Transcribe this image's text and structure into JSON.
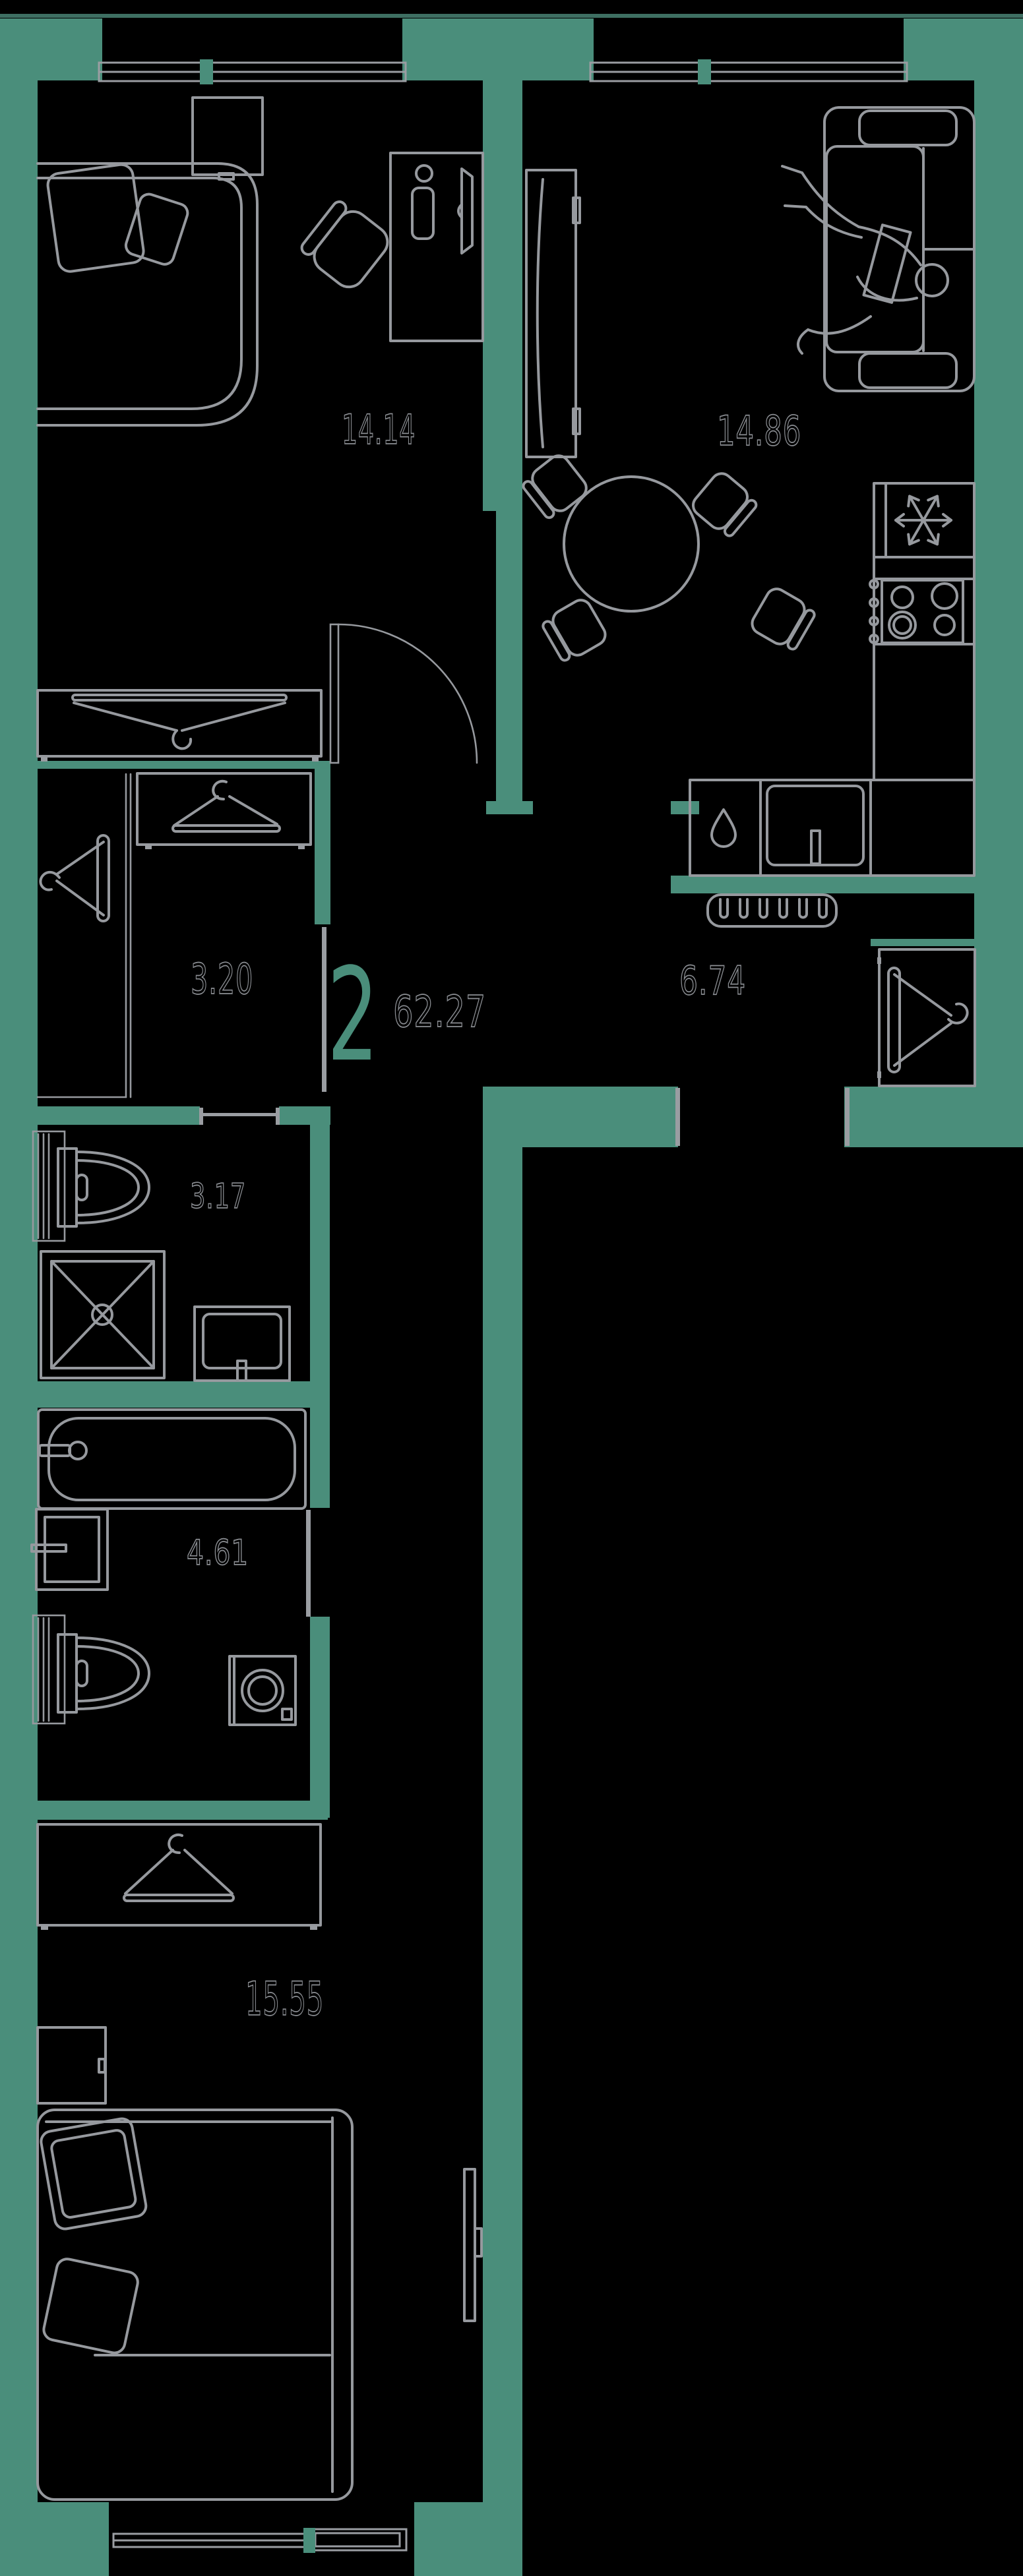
{
  "palette": {
    "background": "#000000",
    "wall": "#4A8E7B",
    "wall_edge_dark": "#3E6F62",
    "furniture_line": "#96999E",
    "label_outline": "#8B8E93",
    "accent": "#4A8E7B"
  },
  "apartment": {
    "rooms_count": "2",
    "total_area": "62.27"
  },
  "areas": {
    "bedroom_top": "14.14",
    "living_kitchen": "14.86",
    "closet": "3.20",
    "hallway": "6.74",
    "bathroom_small": "3.17",
    "bathroom_large": "4.61",
    "bedroom_bottom": "15.55"
  },
  "rooms": [
    {
      "id": "bedroom-top",
      "area": "14.14"
    },
    {
      "id": "living-kitchen",
      "area": "14.86"
    },
    {
      "id": "closet",
      "area": "3.20"
    },
    {
      "id": "hallway",
      "area": "6.74"
    },
    {
      "id": "bathroom-small",
      "area": "3.17"
    },
    {
      "id": "bathroom-large",
      "area": "4.61"
    },
    {
      "id": "bedroom-bottom",
      "area": "15.55"
    }
  ],
  "icons": [
    "window-icon",
    "door-swing-icon",
    "bed-icon",
    "pillow-icon",
    "wardrobe-icon",
    "hanger-icon",
    "dresser-icon",
    "desk-icon",
    "chair-icon",
    "sofa-icon",
    "person-icon",
    "tv-icon",
    "dining-table-icon",
    "fridge-icon",
    "snowflake-icon",
    "stove-icon",
    "kitchen-sink-icon",
    "dishwasher-icon",
    "drop-icon",
    "coat-rack-icon",
    "toilet-icon",
    "shower-icon",
    "washbasin-icon",
    "bathtub-icon",
    "washing-machine-icon",
    "nightstand-icon",
    "duct-icon"
  ]
}
